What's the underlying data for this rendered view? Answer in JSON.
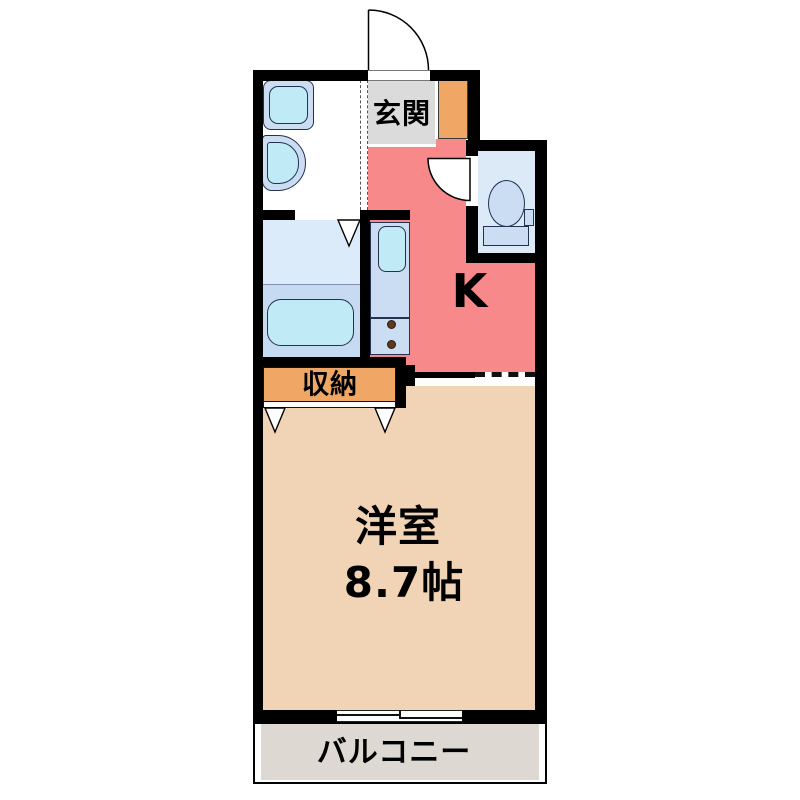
{
  "plan": {
    "type": "apartment-floor-plan",
    "rooms": {
      "genkan": {
        "label": "玄関"
      },
      "kitchen": {
        "label": "K"
      },
      "closet": {
        "label": "収納"
      },
      "western_room": {
        "label": "洋室",
        "size": "8.7帖"
      },
      "balcony": {
        "label": "バルコニー"
      }
    },
    "fixtures": [
      "washing-machine-pan",
      "washbasin",
      "bathtub",
      "kitchen-sink",
      "stove-burners",
      "toilet",
      "entrance-door",
      "toilet-door",
      "bath-door",
      "closet-doors",
      "sliding-window"
    ]
  },
  "colors": {
    "wall": "#000000",
    "kitchen_floor": "#F8898B",
    "genkan_floor": "#DBDBDB",
    "cabinet": "#F0A765",
    "closet": "#F0A765",
    "room_floor": "#F1D3B5",
    "balcony_floor": "#DDD9D2",
    "toilet_floor": "#DCEAF8",
    "bath_upper": "#DCEBFA",
    "bath_lower": "#C6DAF1",
    "fixture_base": "#CBDDF3",
    "fixture_water": "#BFEAF6",
    "fixture_outline": "#243150",
    "burner": "#5C3A20"
  }
}
